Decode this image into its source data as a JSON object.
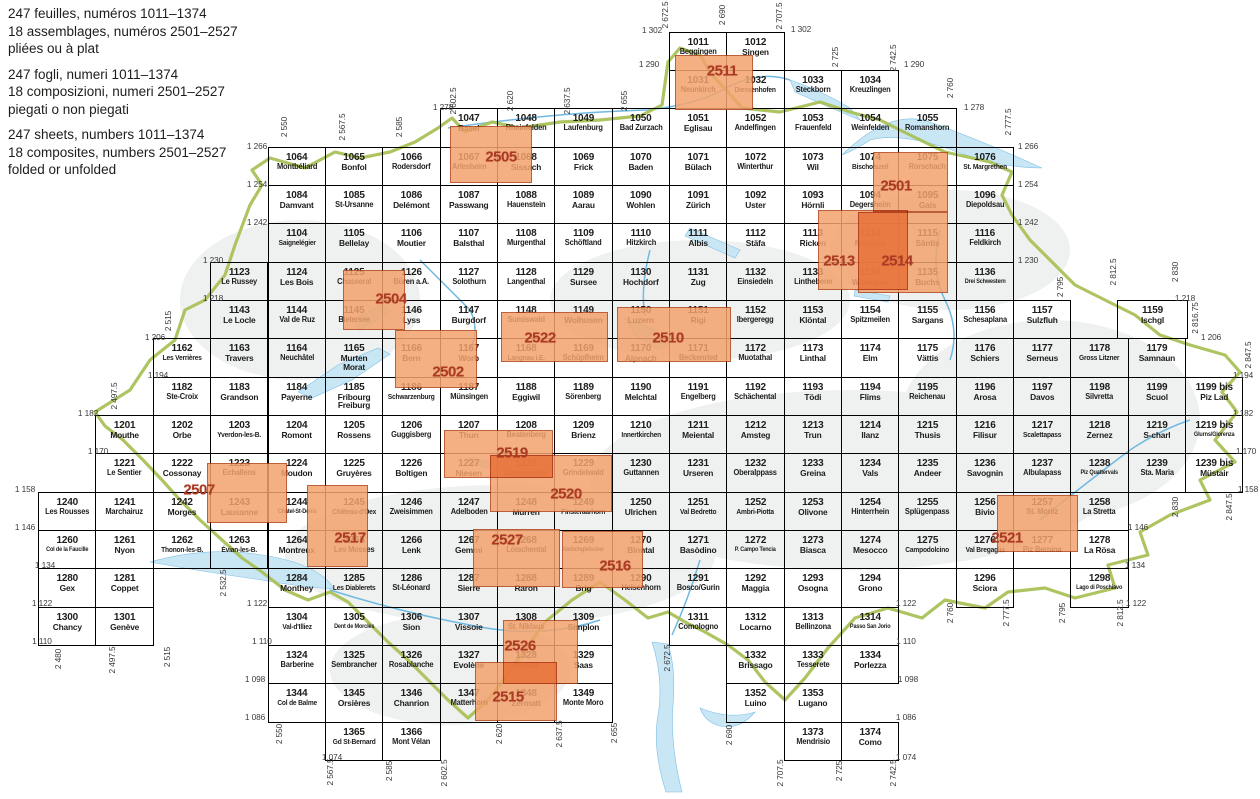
{
  "legend": {
    "paragraphs": [
      [
        "247 feuilles, numéros 1011–1374",
        "18 assemblages, numéros 2501–2527",
        "pliées ou à plat"
      ],
      [
        "247 fogli, numeri 1011–1374",
        "18 composizioni, numeri 2501–2527",
        "piegati o non piegati"
      ],
      [
        "247 sheets, numbers 1011–1374",
        "18 composites, numbers 2501–2527",
        "folded or unfolded"
      ]
    ]
  },
  "colors": {
    "composite_fill": "#f2a26c",
    "composite_border": "#b04519",
    "composite_label": "#ab3a24",
    "grid_line": "#000000",
    "sheet_text": "#1d1d1b",
    "coordinate_label": "#3a3a3a",
    "lake": "#c9e6f5",
    "river": "#6fb9e2",
    "country_border": "#a9c157",
    "hillshade": "#ecefee"
  },
  "sheets": [
    [
      "1011",
      "Beggingen"
    ],
    [
      "1012",
      "Singen"
    ],
    [
      "1031",
      "Neunkirch"
    ],
    [
      "1032",
      "Diessenhofen"
    ],
    [
      "1033",
      "Steckborn"
    ],
    [
      "1034",
      "Kreuzlingen"
    ],
    [
      "1047",
      "Basel"
    ],
    [
      "1048",
      "Rheinfelden"
    ],
    [
      "1049",
      "Laufenburg"
    ],
    [
      "1050",
      "Bad Zurzach"
    ],
    [
      "1051",
      "Eglisau"
    ],
    [
      "1052",
      "Andelfingen"
    ],
    [
      "1053",
      "Frauenfeld"
    ],
    [
      "1054",
      "Weinfelden"
    ],
    [
      "1055",
      "Romanshorn"
    ],
    [
      "1064",
      "Montbéliard"
    ],
    [
      "1065",
      "Bonfol"
    ],
    [
      "1066",
      "Rodersdorf"
    ],
    [
      "1067",
      "Arlesheim"
    ],
    [
      "1068",
      "Sissach"
    ],
    [
      "1069",
      "Frick"
    ],
    [
      "1070",
      "Baden"
    ],
    [
      "1071",
      "Bülach"
    ],
    [
      "1072",
      "Winterthur"
    ],
    [
      "1073",
      "Wil"
    ],
    [
      "1074",
      "Bischofszell"
    ],
    [
      "1075",
      "Rorschach"
    ],
    [
      "1076",
      "St. Margrethen"
    ],
    [
      "1084",
      "Damvant"
    ],
    [
      "1085",
      "St-Ursanne"
    ],
    [
      "1086",
      "Delémont"
    ],
    [
      "1087",
      "Passwang"
    ],
    [
      "1088",
      "Hauenstein"
    ],
    [
      "1089",
      "Aarau"
    ],
    [
      "1090",
      "Wohlen"
    ],
    [
      "1091",
      "Zürich"
    ],
    [
      "1092",
      "Uster"
    ],
    [
      "1093",
      "Hörnli"
    ],
    [
      "1094",
      "Degersheim"
    ],
    [
      "1095",
      "Gais"
    ],
    [
      "1096",
      "Diepoldsau"
    ],
    [
      "1104",
      "Saignelégier"
    ],
    [
      "1105",
      "Bellelay"
    ],
    [
      "1106",
      "Moutier"
    ],
    [
      "1107",
      "Balsthal"
    ],
    [
      "1108",
      "Murgenthal"
    ],
    [
      "1109",
      "Schöftland"
    ],
    [
      "1110",
      "Hitzkirch"
    ],
    [
      "1111",
      "Albis"
    ],
    [
      "1112",
      "Stäfa"
    ],
    [
      "1113",
      "Ricken"
    ],
    [
      "1114",
      "Nesslau"
    ],
    [
      "1115",
      "Säntis"
    ],
    [
      "1116",
      "Feldkirch"
    ],
    [
      "1123",
      "Le Russey"
    ],
    [
      "1124",
      "Les Bois"
    ],
    [
      "1125",
      "Chasseral"
    ],
    [
      "1126",
      "Büren a.A."
    ],
    [
      "1127",
      "Solothurn"
    ],
    [
      "1128",
      "Langenthal"
    ],
    [
      "1129",
      "Sursee"
    ],
    [
      "1130",
      "Hochdorf"
    ],
    [
      "1131",
      "Zug"
    ],
    [
      "1132",
      "Einsiedeln"
    ],
    [
      "1133",
      "Linthebene"
    ],
    [
      "1134",
      "Walensee"
    ],
    [
      "1135",
      "Buchs"
    ],
    [
      "1136",
      "Drei Schwestern"
    ],
    [
      "1143",
      "Le Locle"
    ],
    [
      "1144",
      "Val de Ruz"
    ],
    [
      "1145",
      "Bielersee"
    ],
    [
      "1146",
      "Lyss"
    ],
    [
      "1147",
      "Burgdorf"
    ],
    [
      "1148",
      "Sumiswald"
    ],
    [
      "1149",
      "Wolhusen"
    ],
    [
      "1150",
      "Luzern"
    ],
    [
      "1151",
      "Rigi"
    ],
    [
      "1152",
      "Ibergeregg"
    ],
    [
      "1153",
      "Klöntal"
    ],
    [
      "1154",
      "Spitzmeilen"
    ],
    [
      "1155",
      "Sargans"
    ],
    [
      "1156",
      "Schesaplana"
    ],
    [
      "1157",
      "Sulzfluh"
    ],
    [
      "1159",
      "Ischgl",
      [
        1117,
        300,
        71,
        39
      ]
    ],
    [
      "1162",
      "Les Verrières"
    ],
    [
      "1163",
      "Travers"
    ],
    [
      "1164",
      "Neuchâtel"
    ],
    [
      "1165",
      "Murten\nMorat"
    ],
    [
      "1166",
      "Bern"
    ],
    [
      "1167",
      "Worb"
    ],
    [
      "1168",
      "Langnau i.E."
    ],
    [
      "1169",
      "Schüpfheim"
    ],
    [
      "1170",
      "Alpnach"
    ],
    [
      "1171",
      "Beckenried"
    ],
    [
      "1172",
      "Muotathal"
    ],
    [
      "1173",
      "Linthal"
    ],
    [
      "1174",
      "Elm"
    ],
    [
      "1175",
      "Vättis"
    ],
    [
      "1176",
      "Schiers"
    ],
    [
      "1177",
      "Serneus"
    ],
    [
      "1178",
      "Gross Litzner"
    ],
    [
      "1179",
      "Samnaun"
    ],
    [
      "1182",
      "Ste-Croix"
    ],
    [
      "1183",
      "Grandson"
    ],
    [
      "1184",
      "Payerne"
    ],
    [
      "1185",
      "Fribourg\nFreiburg"
    ],
    [
      "1186",
      "Schwarzenburg"
    ],
    [
      "1187",
      "Münsingen"
    ],
    [
      "1188",
      "Eggiwil"
    ],
    [
      "1189",
      "Sörenberg"
    ],
    [
      "1190",
      "Melchtal"
    ],
    [
      "1191",
      "Engelberg"
    ],
    [
      "1192",
      "Schächental"
    ],
    [
      "1193",
      "Tödi"
    ],
    [
      "1194",
      "Flims"
    ],
    [
      "1195",
      "Reichenau"
    ],
    [
      "1196",
      "Arosa"
    ],
    [
      "1197",
      "Davos"
    ],
    [
      "1198",
      "Silvretta"
    ],
    [
      "1199",
      "Scuol"
    ],
    [
      "1199 bis",
      "Piz Lad"
    ],
    [
      "1201",
      "Mouthe"
    ],
    [
      "1202",
      "Orbe"
    ],
    [
      "1203",
      "Yverdon-les-B."
    ],
    [
      "1204",
      "Romont"
    ],
    [
      "1205",
      "Rossens"
    ],
    [
      "1206",
      "Guggisberg"
    ],
    [
      "1207",
      "Thun"
    ],
    [
      "1208",
      "Beatenberg"
    ],
    [
      "1209",
      "Brienz"
    ],
    [
      "1210",
      "Innertkirchen"
    ],
    [
      "1211",
      "Meiental"
    ],
    [
      "1212",
      "Amsteg"
    ],
    [
      "1213",
      "Trun"
    ],
    [
      "1214",
      "Ilanz"
    ],
    [
      "1215",
      "Thusis"
    ],
    [
      "1216",
      "Filisur"
    ],
    [
      "1217",
      "Scalettapass"
    ],
    [
      "1218",
      "Zernez"
    ],
    [
      "1219",
      "S-charl"
    ],
    [
      "1219 bis",
      "Glurns/Glorenza"
    ],
    [
      "1221",
      "Le Sentier"
    ],
    [
      "1222",
      "Cossonay"
    ],
    [
      "1223",
      "Echallens"
    ],
    [
      "1224",
      "Moudon"
    ],
    [
      "1225",
      "Gruyères"
    ],
    [
      "1226",
      "Boltigen"
    ],
    [
      "1227",
      "Niesen"
    ],
    [
      "1228",
      "Lauterbrunnen"
    ],
    [
      "1229",
      "Grindelwald"
    ],
    [
      "1230",
      "Guttannen"
    ],
    [
      "1231",
      "Urseren"
    ],
    [
      "1232",
      "Oberalppass"
    ],
    [
      "1233",
      "Greina"
    ],
    [
      "1234",
      "Vals"
    ],
    [
      "1235",
      "Andeer"
    ],
    [
      "1236",
      "Savognin"
    ],
    [
      "1237",
      "Albulapass"
    ],
    [
      "1238",
      "Piz Quattervals"
    ],
    [
      "1239",
      "Sta. Maria"
    ],
    [
      "1239 bis",
      "Müstair"
    ],
    [
      "1240",
      "Les Rousses"
    ],
    [
      "1241",
      "Marchairuz"
    ],
    [
      "1242",
      "Morges"
    ],
    [
      "1243",
      "Lausanne"
    ],
    [
      "1244",
      "Châtel-St-Denis"
    ],
    [
      "1245",
      "Château-d'Oex"
    ],
    [
      "1246",
      "Zweisimmen"
    ],
    [
      "1247",
      "Adelboden"
    ],
    [
      "1248",
      "Mürren"
    ],
    [
      "1249",
      "Finsteraarhorn"
    ],
    [
      "1250",
      "Ulrichen"
    ],
    [
      "1251",
      "Val Bedretto"
    ],
    [
      "1252",
      "Ambri-Piotta"
    ],
    [
      "1253",
      "Olivone"
    ],
    [
      "1254",
      "Hinterrhein"
    ],
    [
      "1255",
      "Splügenpass"
    ],
    [
      "1256",
      "Bivio"
    ],
    [
      "1257",
      "St. Moritz"
    ],
    [
      "1258",
      "La Stretta"
    ],
    [
      "1260",
      "Col de la Faucille"
    ],
    [
      "1261",
      "Nyon"
    ],
    [
      "1262",
      "Thonon-les-B."
    ],
    [
      "1263",
      "Évian-les-B."
    ],
    [
      "1264",
      "Montreux"
    ],
    [
      "1265",
      "Les Mosses"
    ],
    [
      "1266",
      "Lenk"
    ],
    [
      "1267",
      "Gemmi"
    ],
    [
      "1268",
      "Lötschental"
    ],
    [
      "1269",
      "Aletschgletscher"
    ],
    [
      "1270",
      "Binntal"
    ],
    [
      "1271",
      "Basòdino"
    ],
    [
      "1272",
      "P. Campo Tencia"
    ],
    [
      "1273",
      "Biasca"
    ],
    [
      "1274",
      "Mesocco"
    ],
    [
      "1275",
      "Campodolcino"
    ],
    [
      "1276",
      "Val Bregaglia"
    ],
    [
      "1277",
      "Piz Bernina"
    ],
    [
      "1278",
      "La Rösa"
    ],
    [
      "1280",
      "Gex"
    ],
    [
      "1281",
      "Coppet"
    ],
    [
      "1284",
      "Monthey"
    ],
    [
      "1285",
      "Les Diablerets"
    ],
    [
      "1286",
      "St-Léonard"
    ],
    [
      "1287",
      "Sierre"
    ],
    [
      "1288",
      "Raron"
    ],
    [
      "1289",
      "Brig"
    ],
    [
      "1290",
      "Helsenhorn"
    ],
    [
      "1291",
      "Bosco/Gurin"
    ],
    [
      "1292",
      "Maggia"
    ],
    [
      "1293",
      "Osogna"
    ],
    [
      "1294",
      "Grono"
    ],
    [
      "1296",
      "Sciora"
    ],
    [
      "1298",
      "Lago di Poschiavo"
    ],
    [
      "1300",
      "Chancy"
    ],
    [
      "1301",
      "Genève"
    ],
    [
      "1304",
      "Val-d'Illiez"
    ],
    [
      "1305",
      "Dent de Morcles"
    ],
    [
      "1306",
      "Sion"
    ],
    [
      "1307",
      "Vissoie"
    ],
    [
      "1308",
      "St. Niklaus"
    ],
    [
      "1309",
      "Simplon"
    ],
    [
      "1311",
      "Comologno"
    ],
    [
      "1312",
      "Locarno"
    ],
    [
      "1313",
      "Bellinzona"
    ],
    [
      "1314",
      "Passo San Jorio"
    ],
    [
      "1324",
      "Barberine"
    ],
    [
      "1325",
      "Sembrancher"
    ],
    [
      "1326",
      "Rosablanche"
    ],
    [
      "1327",
      "Evolène"
    ],
    [
      "1328",
      "Randa"
    ],
    [
      "1329",
      "Saas"
    ],
    [
      "1332",
      "Brissago"
    ],
    [
      "1333",
      "Tesserete"
    ],
    [
      "1334",
      "Porlezza"
    ],
    [
      "1344",
      "Col de Balme"
    ],
    [
      "1345",
      "Orsières"
    ],
    [
      "1346",
      "Chanrion"
    ],
    [
      "1347",
      "Matterhorn"
    ],
    [
      "1348",
      "Zermatt"
    ],
    [
      "1349",
      "Monte Moro"
    ],
    [
      "1352",
      "Luino"
    ],
    [
      "1353",
      "Lugano"
    ],
    [
      "1365",
      "Gd St-Bernard"
    ],
    [
      "1366",
      "Mont Vélan"
    ],
    [
      "1373",
      "Mendrisio"
    ],
    [
      "1374",
      "Como"
    ]
  ],
  "composites": [
    {
      "num": "2511",
      "x": 675,
      "y": 55,
      "w": 78,
      "h": 55,
      "lx": 722,
      "ly": 71
    },
    {
      "num": "2505",
      "x": 450,
      "y": 126,
      "w": 82,
      "h": 57,
      "lx": 501,
      "ly": 157
    },
    {
      "num": "2501",
      "x": 873,
      "y": 152,
      "w": 75,
      "h": 60,
      "lx": 896,
      "ly": 186
    },
    {
      "num": "2513",
      "x": 818,
      "y": 210,
      "w": 90,
      "h": 80,
      "lx": 839,
      "ly": 261
    },
    {
      "num": "2514",
      "x": 858,
      "y": 212,
      "w": 90,
      "h": 81,
      "lx": 897,
      "ly": 261
    },
    {
      "num": "2504",
      "x": 343,
      "y": 270,
      "w": 62,
      "h": 60,
      "lx": 391,
      "ly": 299
    },
    {
      "num": "2522",
      "x": 501,
      "y": 312,
      "w": 107,
      "h": 50,
      "lx": 540,
      "ly": 338
    },
    {
      "num": "2510",
      "x": 617,
      "y": 307,
      "w": 114,
      "h": 55,
      "lx": 668,
      "ly": 338
    },
    {
      "num": "2502",
      "x": 395,
      "y": 330,
      "w": 82,
      "h": 58,
      "lx": 448,
      "ly": 372
    },
    {
      "num": "2519",
      "x": 444,
      "y": 430,
      "w": 109,
      "h": 48,
      "lx": 512,
      "ly": 453
    },
    {
      "num": "2507",
      "x": 207,
      "y": 463,
      "w": 80,
      "h": 60,
      "lx": 199,
      "ly": 490
    },
    {
      "num": "2520",
      "x": 490,
      "y": 455,
      "w": 122,
      "h": 57,
      "lx": 566,
      "ly": 494
    },
    {
      "num": "2517",
      "x": 307,
      "y": 485,
      "w": 61,
      "h": 82,
      "lx": 350,
      "ly": 538
    },
    {
      "num": "2527",
      "x": 473,
      "y": 529,
      "w": 87,
      "h": 58,
      "lx": 507,
      "ly": 540
    },
    {
      "num": "2521",
      "x": 997,
      "y": 495,
      "w": 81,
      "h": 57,
      "lx": 1007,
      "ly": 538
    },
    {
      "num": "2516",
      "x": 562,
      "y": 531,
      "w": 81,
      "h": 57,
      "lx": 615,
      "ly": 566
    },
    {
      "num": "2526",
      "x": 503,
      "y": 620,
      "w": 75,
      "h": 64,
      "lx": 520,
      "ly": 646
    },
    {
      "num": "2515",
      "x": 475,
      "y": 662,
      "w": 82,
      "h": 59,
      "lx": 508,
      "ly": 697
    }
  ],
  "edge_labels": {
    "horizontal": [
      [
        "1 302",
        652,
        30
      ],
      [
        "1 302",
        801,
        29
      ],
      [
        "1 290",
        649,
        64
      ],
      [
        "1 290",
        914,
        64
      ],
      [
        "1 278",
        443,
        107
      ],
      [
        "1 278",
        974,
        107
      ],
      [
        "1 266",
        257,
        146
      ],
      [
        "1 266",
        1028,
        146
      ],
      [
        "1 254",
        257,
        184
      ],
      [
        "1 254",
        1028,
        184
      ],
      [
        "1 242",
        257,
        222
      ],
      [
        "1 242",
        1028,
        222
      ],
      [
        "1 230",
        213,
        260
      ],
      [
        "1 230",
        1028,
        260
      ],
      [
        "1 218",
        213,
        298
      ],
      [
        "1 218",
        1185,
        298
      ],
      [
        "1 206",
        155,
        337
      ],
      [
        "1 206",
        1211,
        337
      ],
      [
        "1 194",
        158,
        375
      ],
      [
        "1 194",
        1243,
        375
      ],
      [
        "1 182",
        88,
        413
      ],
      [
        "1 182",
        1243,
        413
      ],
      [
        "1 170",
        98,
        451
      ],
      [
        "1 170",
        1246,
        451
      ],
      [
        "1 158",
        25,
        489
      ],
      [
        "1 158",
        1248,
        489
      ],
      [
        "1 146",
        25,
        527
      ],
      [
        "1 146",
        1138,
        527
      ],
      [
        "1 134",
        45,
        565
      ],
      [
        "1 134",
        1135,
        565
      ],
      [
        "1 122",
        42,
        603
      ],
      [
        "1 122",
        257,
        603
      ],
      [
        "1 122",
        906,
        603
      ],
      [
        "1 122",
        1136,
        603
      ],
      [
        "1 110",
        42,
        641
      ],
      [
        "1 110",
        262,
        641
      ],
      [
        "1 110",
        906,
        641
      ],
      [
        "1 098",
        255,
        679
      ],
      [
        "1 098",
        908,
        679
      ],
      [
        "1 086",
        255,
        717
      ],
      [
        "1 086",
        906,
        717
      ],
      [
        "1 074",
        332,
        757
      ],
      [
        "1 074",
        906,
        757
      ]
    ],
    "vertical": [
      [
        "2 672.5",
        665,
        15
      ],
      [
        "2 690",
        722,
        15
      ],
      [
        "2 707.5",
        779,
        16
      ],
      [
        "2 725",
        835,
        57
      ],
      [
        "2 742.5",
        893,
        58
      ],
      [
        "2 760",
        950,
        88
      ],
      [
        "2 777.5",
        1008,
        122
      ],
      [
        "2 550",
        284,
        127
      ],
      [
        "2 567.5",
        342,
        127
      ],
      [
        "2 585",
        399,
        127
      ],
      [
        "2 602.5",
        453,
        101
      ],
      [
        "2 620",
        510,
        101
      ],
      [
        "2 637.5",
        567,
        101
      ],
      [
        "2 655",
        624,
        101
      ],
      [
        "2 515",
        168,
        321
      ],
      [
        "2 497.5",
        114,
        396
      ],
      [
        "2 795",
        1060,
        287
      ],
      [
        "2 812.5",
        1113,
        272
      ],
      [
        "2 830",
        1175,
        272
      ],
      [
        "2 816.75",
        1195,
        318
      ],
      [
        "2 847.5",
        1248,
        355
      ],
      [
        "2 830",
        1175,
        507
      ],
      [
        "2 847.5",
        1229,
        507
      ],
      [
        "2 480",
        58,
        659
      ],
      [
        "2 497.5",
        112,
        660
      ],
      [
        "2 515",
        167,
        657
      ],
      [
        "2 532.5",
        223,
        583
      ],
      [
        "2 550",
        279,
        734
      ],
      [
        "2 567.5",
        330,
        772
      ],
      [
        "2 585",
        389,
        771
      ],
      [
        "2 602.5",
        444,
        773
      ],
      [
        "2 620",
        499,
        734
      ],
      [
        "2 637.5",
        559,
        734
      ],
      [
        "2 655",
        614,
        733
      ],
      [
        "2 672.5",
        667,
        658
      ],
      [
        "2 690",
        729,
        735
      ],
      [
        "2 707.5",
        780,
        773
      ],
      [
        "2 725",
        839,
        771
      ],
      [
        "2 742.5",
        893,
        773
      ],
      [
        "2 760",
        950,
        613
      ],
      [
        "2 777.5",
        1006,
        613
      ],
      [
        "2 795",
        1062,
        613
      ],
      [
        "2 812.5",
        1120,
        613
      ]
    ]
  }
}
